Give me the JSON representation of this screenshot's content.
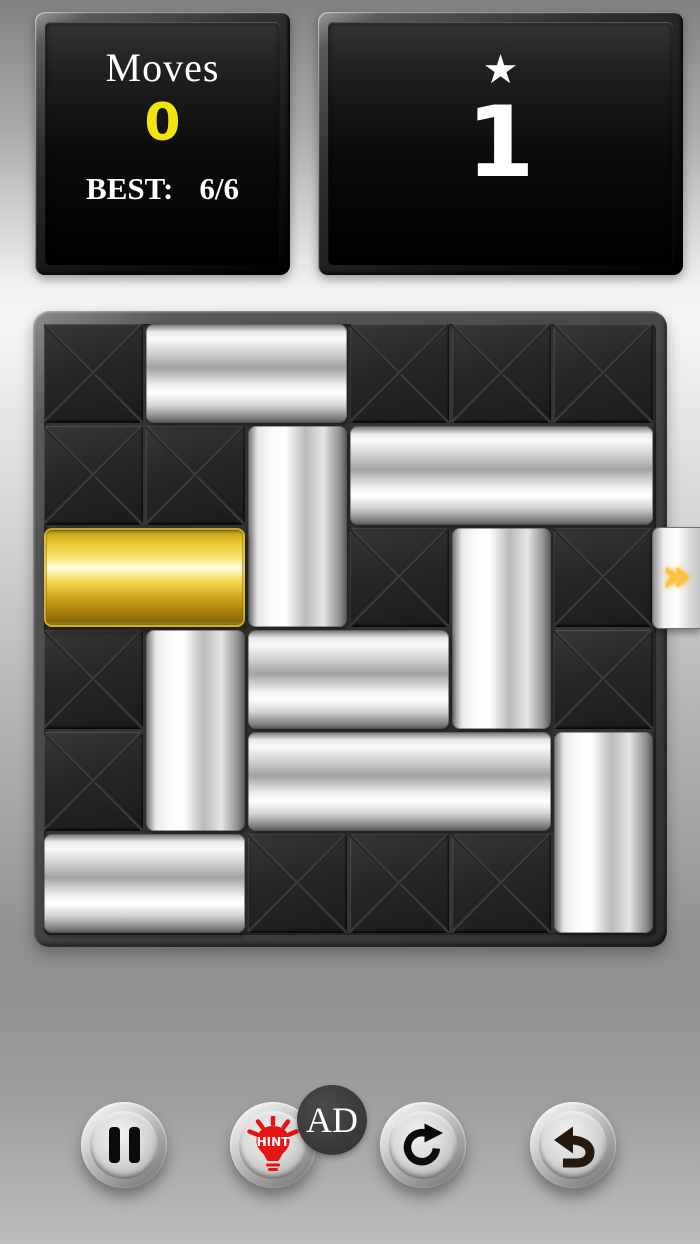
{
  "hud": {
    "moves_label": "Moves",
    "moves_value": "0",
    "best_label": "BEST:",
    "best_value": "6/6",
    "star_icon": "★",
    "level_value": "1"
  },
  "colors": {
    "moves_value": "#f0e40e",
    "gold_block": "#f3d748",
    "silver_block": "#e9e9e9",
    "exit_chevron": "#ffc133",
    "hint_icon_red": "#e81414",
    "panel_bg": "#0b0b0b"
  },
  "board": {
    "rows": 6,
    "cols": 6,
    "empty_cells": [
      [
        0,
        0
      ],
      [
        0,
        3
      ],
      [
        0,
        4
      ],
      [
        0,
        5
      ],
      [
        1,
        0
      ],
      [
        1,
        1
      ],
      [
        2,
        3
      ],
      [
        2,
        5
      ],
      [
        3,
        0
      ],
      [
        3,
        5
      ],
      [
        4,
        0
      ],
      [
        5,
        2
      ],
      [
        5,
        3
      ],
      [
        5,
        4
      ]
    ],
    "blocks": [
      {
        "row": 0,
        "col": 1,
        "len": 2,
        "orient": "h",
        "type": "silver"
      },
      {
        "row": 1,
        "col": 2,
        "len": 2,
        "orient": "v",
        "type": "silver"
      },
      {
        "row": 1,
        "col": 3,
        "len": 3,
        "orient": "h",
        "type": "silver"
      },
      {
        "row": 2,
        "col": 0,
        "len": 2,
        "orient": "h",
        "type": "gold"
      },
      {
        "row": 2,
        "col": 4,
        "len": 2,
        "orient": "v",
        "type": "silver"
      },
      {
        "row": 3,
        "col": 1,
        "len": 2,
        "orient": "v",
        "type": "silver"
      },
      {
        "row": 3,
        "col": 2,
        "len": 2,
        "orient": "h",
        "type": "silver"
      },
      {
        "row": 4,
        "col": 2,
        "len": 3,
        "orient": "h",
        "type": "silver"
      },
      {
        "row": 4,
        "col": 5,
        "len": 2,
        "orient": "v",
        "type": "silver"
      },
      {
        "row": 5,
        "col": 0,
        "len": 2,
        "orient": "h",
        "type": "silver"
      }
    ],
    "exit": {
      "row": 2,
      "side": "right",
      "chevron": "»"
    }
  },
  "toolbar": {
    "hint_label": "HINT",
    "ad_badge": "AD"
  }
}
